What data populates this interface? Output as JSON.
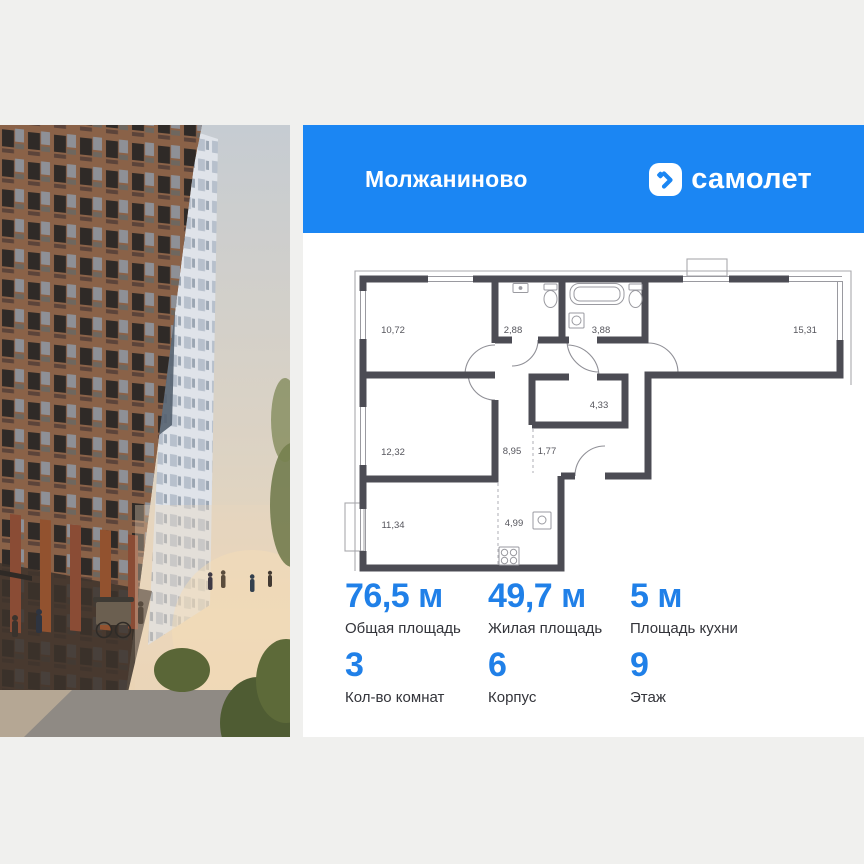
{
  "header": {
    "project_name": "Молжаниново",
    "brand_wordmark": "самолет"
  },
  "floor_plan": {
    "rooms": [
      {
        "id": "bedroom-top-left",
        "area": "10,72"
      },
      {
        "id": "bathroom-small",
        "area": "2,88"
      },
      {
        "id": "bathroom-large",
        "area": "3,88"
      },
      {
        "id": "living-room-right",
        "area": "15,31"
      },
      {
        "id": "hall",
        "area": "4,33"
      },
      {
        "id": "bedroom-middle-left",
        "area": "12,32"
      },
      {
        "id": "corridor",
        "area": "8,95"
      },
      {
        "id": "closet",
        "area": "1,77"
      },
      {
        "id": "bedroom-bottom-left",
        "area": "11,34"
      },
      {
        "id": "kitchen-zone",
        "area": "4,99"
      }
    ]
  },
  "stats": {
    "row1": [
      {
        "value": "76,5 м",
        "label": "Общая площадь"
      },
      {
        "value": "49,7 м",
        "label": "Жилая площадь"
      },
      {
        "value": "5 м",
        "label": "Площадь кухни"
      }
    ],
    "row2": [
      {
        "value": "3",
        "label": "Кол-во комнат"
      },
      {
        "value": "6",
        "label": "Корпус"
      },
      {
        "value": "9",
        "label": "Этаж"
      }
    ]
  },
  "colors": {
    "brand_blue": "#1b86f3",
    "stat_number_blue": "#2080e8",
    "wall_dark": "#4c4c54",
    "page_background": "#f0f0ee"
  }
}
